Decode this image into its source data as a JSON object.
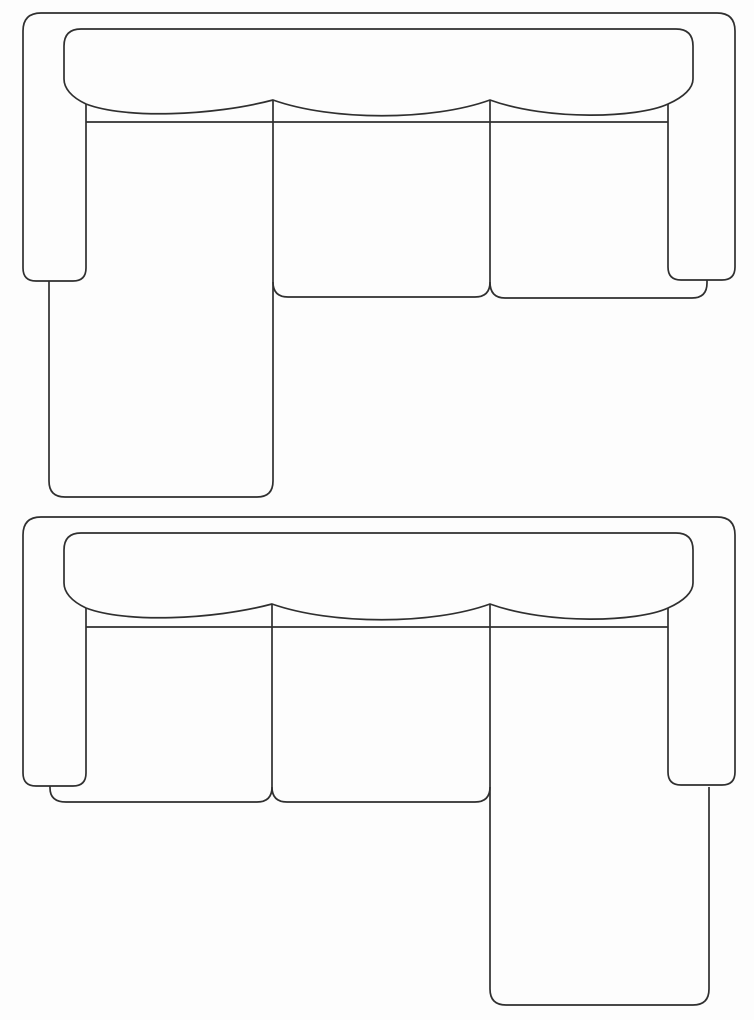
{
  "canvas": {
    "width": 754,
    "height": 1020,
    "background": "#fdfdfd",
    "stroke_color": "#2f2f2f",
    "stroke_width": 1.7
  },
  "diagrams": [
    {
      "id": "sectional-sofa-left-chaise",
      "name": "sofa-top-view-left-chaise",
      "paths": [
        {
          "name": "outer-frame-back-and-arms",
          "d": "M 86,104 L 86,268 Q 86,281 73,281 L 36,281 Q 23,281 23,268 L 23,31 Q 23,13 41,13 L 717,13 Q 735,13 735,31 L 735,267 Q 735,280 722,280 L 681,280 Q 668,280 668,267 L 668,104"
        },
        {
          "name": "back-cushions-scalloped",
          "d": "M 86,104 C 125,119 212,116 273,100 C 332,121 432,121 490,100 C 548,121 638,118 668,104 C 684,97 693,88 693,79 L 693,46 Q 693,29 676,29 L 81,29 Q 64,29 64,46 L 64,79 C 64,88 71,97 86,104 Z"
        },
        {
          "name": "seat-back-line",
          "d": "M 86,122 L 668,122"
        },
        {
          "name": "seat-divider-line",
          "d": "M 490,100 L 490,282"
        },
        {
          "name": "chaise-left",
          "d": "M 273,100 L 273,481 Q 273,497 257,497 L 65,497 Q 49,497 49,481 L 49,281"
        },
        {
          "name": "middle-seat-cushion",
          "d": "M 273,282 Q 273,297 288,297 L 475,297 Q 490,297 490,282"
        },
        {
          "name": "right-seat-cushion",
          "d": "M 490,282 Q 490,298 505,298 L 692,298 Q 707,298 707,283 L 707,280"
        }
      ]
    },
    {
      "id": "sectional-sofa-right-chaise",
      "name": "sofa-top-view-right-chaise",
      "paths": [
        {
          "name": "outer-frame-back-and-arms",
          "d": "M 86,608 L 86,773 Q 86,786 73,786 L 36,786 Q 23,786 23,773 L 23,535 Q 23,517 41,517 L 717,517 Q 735,517 735,535 L 735,772 Q 735,785 722,785 L 681,785 Q 668,785 668,772 L 668,608"
        },
        {
          "name": "back-cushions-scalloped",
          "d": "M 86,608 C 125,623 212,620 272,604 C 332,625 432,625 490,604 C 548,625 638,622 668,608 C 684,601 693,592 693,583 L 693,550 Q 693,533 676,533 L 81,533 Q 64,533 64,550 L 64,583 C 64,592 71,601 86,608 Z"
        },
        {
          "name": "seat-back-line",
          "d": "M 86,627 L 668,627"
        },
        {
          "name": "seat-divider-line",
          "d": "M 272,604 L 272,787"
        },
        {
          "name": "chaise-right",
          "d": "M 490,604 L 490,989 Q 490,1005 506,1005 L 693,1005 Q 709,1005 709,989 L 709,787"
        },
        {
          "name": "middle-seat-cushion",
          "d": "M 490,787 Q 490,802 475,802 L 287,802 Q 272,802 272,787"
        },
        {
          "name": "left-seat-cushion",
          "d": "M 272,787 Q 272,802 257,802 L 66,802 Q 50,802 50,788 L 50,786"
        }
      ]
    }
  ]
}
